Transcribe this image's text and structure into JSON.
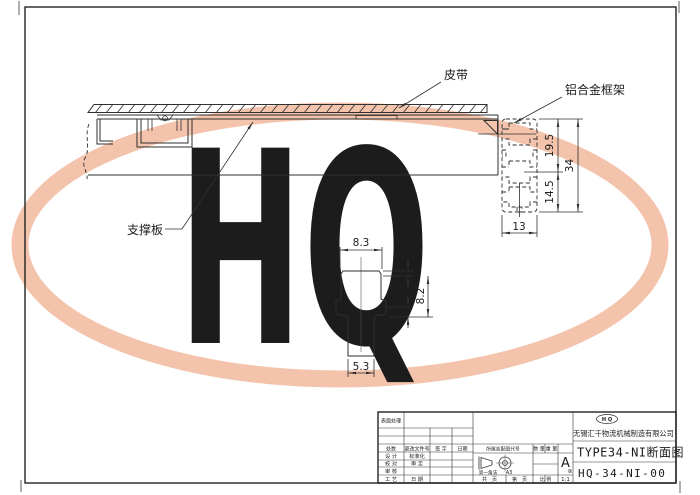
{
  "watermark": {
    "text": "HQ",
    "band_color": "#f3c3ab",
    "letter_color": "#f7d0bc"
  },
  "main_view": {
    "labels": {
      "belt": "皮带",
      "aluminum_frame": "铝合金框架",
      "support_plate": "支撑板"
    },
    "profile_dims": {
      "upper": "19.5",
      "lower": "14.5",
      "total": "34",
      "width": "13"
    }
  },
  "detail_view": {
    "dims": {
      "top_width": "8.3",
      "top_step": "1",
      "slot_height": "8.2",
      "lip": "2",
      "bottom_width": "5.3"
    }
  },
  "title_block": {
    "surface_treatment": "表面处理",
    "rev_headers": {
      "count": "处数",
      "change_doc_no": "更改文件号",
      "signature": "签 字",
      "date": "日期"
    },
    "roles": {
      "design": "设 计",
      "check": "校 对",
      "review": "审 核",
      "process": "工 艺",
      "standardization": "标准化",
      "approval": "审 定",
      "date": "日 期"
    },
    "assembly_code_label": "所属装配图代号",
    "projection": {
      "method": "第一角法",
      "paper": "A3"
    },
    "quantity_label": "数 量",
    "weight_label": "重 量",
    "version_letter": "A",
    "version_suffix": "版",
    "pages": {
      "total": "共　页",
      "index": "第　页",
      "scale_label": "比 例",
      "scale_value": "1:1"
    },
    "logo_text": "H Q",
    "company": "无锡汇千物流机械制造有限公司",
    "drawing_title": "TYPE34-NI断面图",
    "drawing_number": "HQ-34-NI-00"
  }
}
